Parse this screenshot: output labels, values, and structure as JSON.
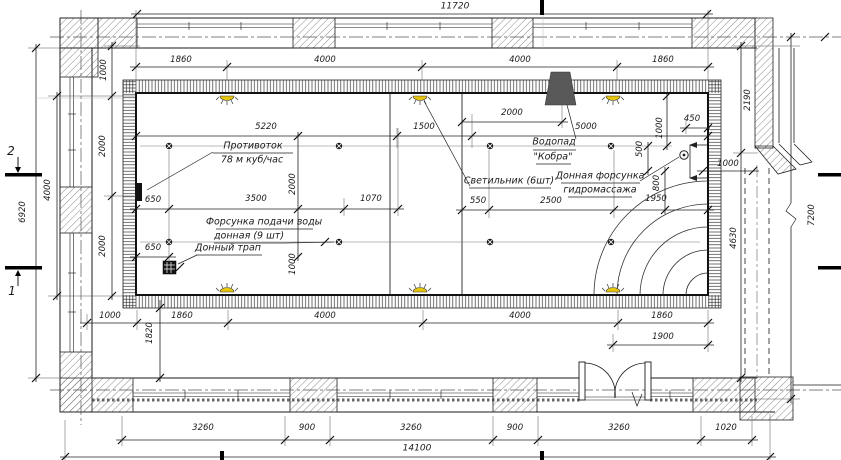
{
  "annotations": {
    "counterflow": {
      "line1": "Противоток",
      "line2": "78 м куб/час"
    },
    "bottom_nozzle": {
      "line1": "Форсунка подачи воды",
      "line2": "донная (9 шт)"
    },
    "floor_drain": {
      "label": "Донный трап"
    },
    "light": {
      "label": "Светильник (6шт)"
    },
    "waterfall": {
      "line1": "Водопад",
      "line2": "\"Кобра\""
    },
    "hydromassage": {
      "line1": "Донная форсунка",
      "line2": "гидромассажа"
    }
  },
  "axes": {
    "section_2": "2",
    "section_1": "1"
  },
  "dims": {
    "top_total": "11720",
    "top_row": [
      "1860",
      "4000",
      "4000",
      "1860"
    ],
    "pool_top": [
      "5220",
      "1500",
      "2000",
      "5000",
      "450"
    ],
    "pool_mid": [
      "650",
      "3500",
      "1070",
      "550",
      "2500",
      "1950"
    ],
    "pool_bottom_650": "650",
    "pool_v": [
      "2000",
      "1000"
    ],
    "right_cluster_v": [
      "1000",
      "500",
      "800"
    ],
    "right_1000": "1000",
    "left_v": {
      "total": "6920",
      "pool": "4000",
      "segs": [
        "1000",
        "2000",
        "2000"
      ]
    },
    "right_v": {
      "top": "2190",
      "mid": "4630",
      "total": "7200"
    },
    "below_pool": [
      "1000",
      "1860",
      "4000",
      "4000",
      "1860"
    ],
    "door_1900": "1900",
    "left_1820": "1820",
    "bottom_row": [
      "3260",
      "900",
      "3260",
      "900",
      "3260",
      "1020"
    ],
    "bottom_total": "14100"
  }
}
